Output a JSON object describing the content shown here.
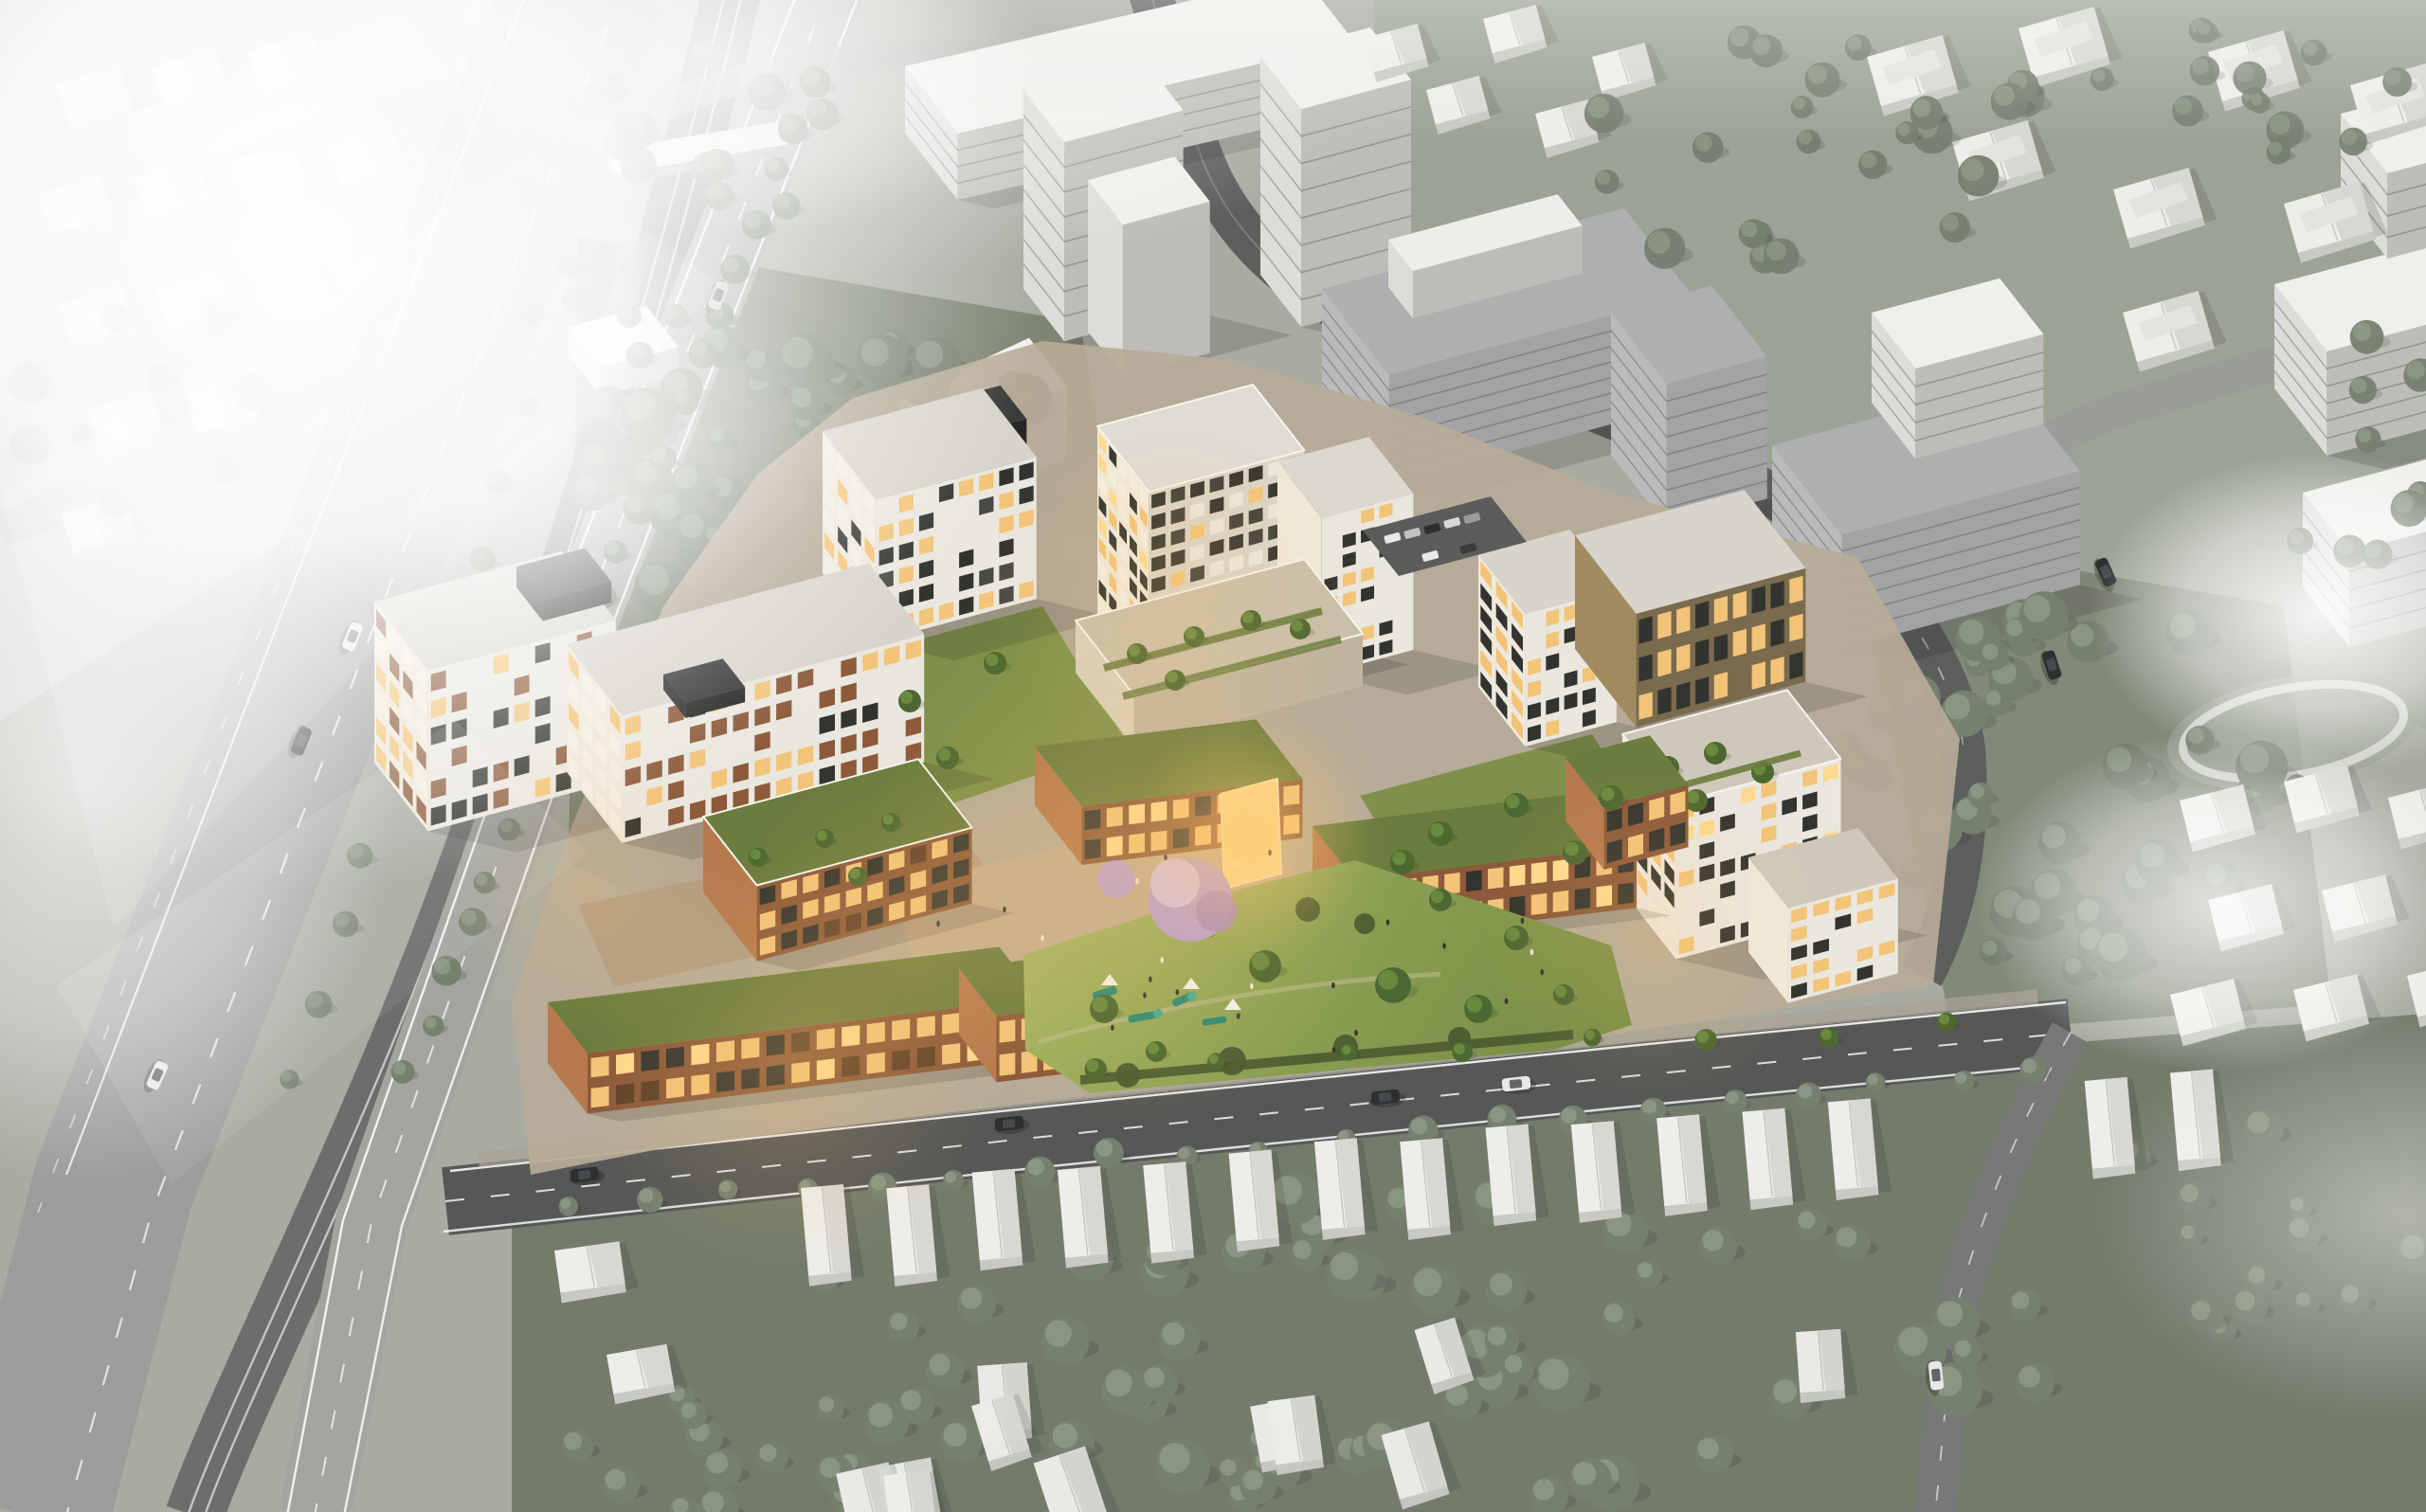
{
  "scene": {
    "kind": "architectural-aerial-render",
    "labels": {
      "root": "Aerial architectural rendering of a proposed mixed-use residential development shown in full colour within a white greyscale massing model of the surrounding suburb",
      "context": "Greyscale context: white massing towers, slabs and hip-roof houses, grey roads and desaturated trees",
      "highway": "Multi-lane highway with central rail corridor and overpass, upper left",
      "development": "Proposed development: brick podium terraces, white-grid apartment towers, rooftop gardens and courtyards, warmly lit windows",
      "tower": "Ten-storey apartment tower with dark glazing and white frame grid",
      "park": "Sunlit public park with lawns, shrubs and paths in front of the development",
      "playground": "Teal playground equipment with white shade canopies",
      "jacaranda": "Purple flowering jacaranda tree beside the plaza",
      "front-street": "Dark asphalt street with lane markings and cars along the site frontage",
      "houses": "Rows of white hip-roof suburban houses among grey trees",
      "parking": "Small surface car park north-east of the tower",
      "fog": "Soft white fog and light bloom over the corners of the model"
    },
    "counts": {
      "site_buildings": 12,
      "street_cars_visible": 7,
      "fog_patches": 6
    }
  },
  "palette": {
    "ground": "#a8aba1",
    "groundTrees": "#7b8371",
    "groundBottom": "#747b6b",
    "grassCtx": "#9aa192",
    "hwy": "#9b9d9a",
    "avenue": "#a2a4a0",
    "ballast": "#6b6e6b",
    "rail": "#c3c5c2",
    "streetDark": "#565856",
    "roadNE": "#606260",
    "lane": "#ffffff",
    "ctxTop": "#f0efec",
    "ctxFaceW": "#dddcd8",
    "ctxFaceS": "#bdbcb8",
    "ctxGrey": "#b9babb",
    "ctxGreyS": "#a2a3a4",
    "ctxGreyRoof": "#adafb0",
    "treeCtx": "#76806f",
    "treeCtxLit": "#98a38f",
    "treeSite": "#4d6831",
    "treeSiteLit": "#7da04a",
    "lawn": "#7e9049",
    "lawnLit": "#a3b45f",
    "roofGarden": "#6a7c3e",
    "parkLawn": "#8da254",
    "brick": "#8c5a3a",
    "brickLit": "#b5794d",
    "brickShade": "#5e4129",
    "warm": "#f2c478",
    "warmBright": "#ffd98f",
    "darkGlass": "#33342f",
    "whiteFrame": "#eae7df",
    "roofConc": "#d8d4cb",
    "darkMetal": "#2f302f",
    "bronze": "#7a6a4e",
    "bronzeLit": "#a08a60",
    "paving": "#c2ad92",
    "pavingWarm": "#c79a6e",
    "jac": "#b99fd0",
    "jacLit": "#d6c3e6",
    "play": "#2f8a74",
    "playLit": "#49a98e",
    "carDark": "#2e2f30",
    "carWhite": "#e8e8e6",
    "shadow": "rgba(20,22,18,0.15)"
  }
}
